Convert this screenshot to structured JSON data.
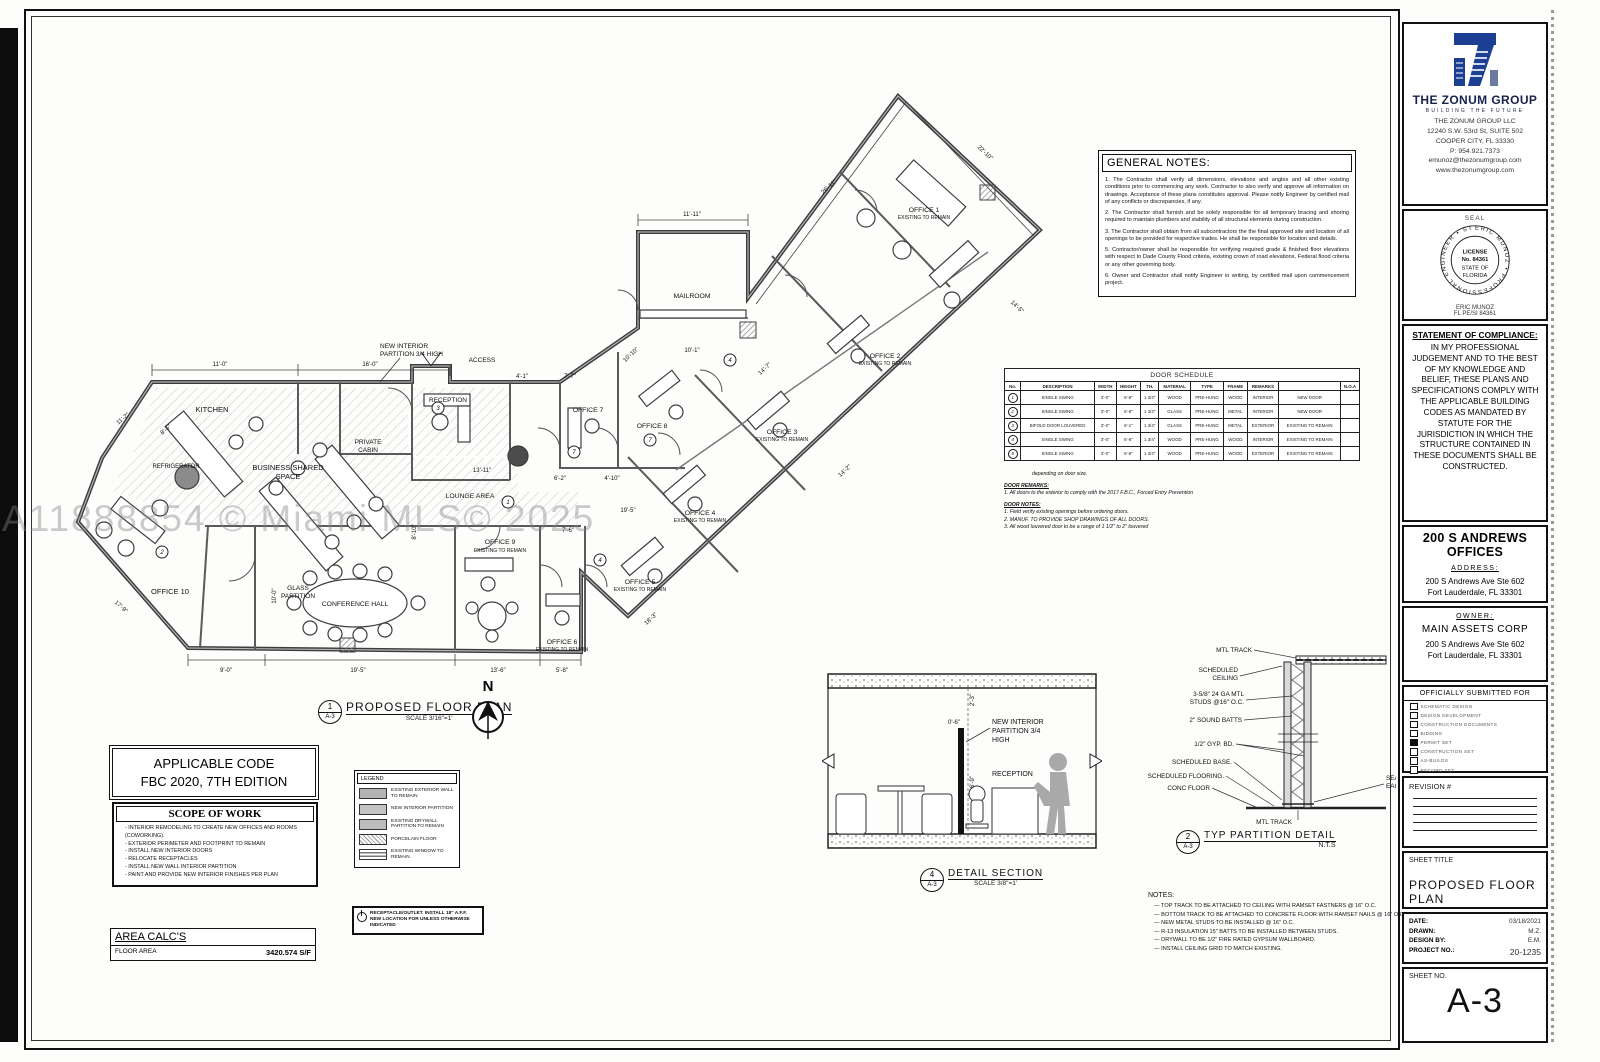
{
  "watermark": "A11888854 © Miami MLS© 2025",
  "title_block": {
    "company": {
      "name": "THE ZONUM GROUP",
      "tagline": "BUILDING THE FUTURE",
      "llc": "THE ZONUM GROUP LLC",
      "address1": "12240 S.W. 53rd St, SUITE 502",
      "address2": "COOPER CITY, FL 33330",
      "phone": "P: 954.921.7373",
      "email": "emunoz@thezonumgroup.com",
      "website": "www.thezonumgroup.com",
      "logo_color": "#1c3f94"
    },
    "seal": {
      "label": "SEAL",
      "ring_text": "ERIC MUNOZ • PROFESSIONAL ENGINEER • STATE OF FLORIDA •",
      "line1": "LICENSE",
      "line2": "No. 84361",
      "line3": "STATE OF",
      "line4": "FLORIDA",
      "engineer": "ERIC MUNOZ",
      "license": "FL PE/SI 84361"
    },
    "compliance": {
      "heading": "STATEMENT OF COMPLIANCE:",
      "body": "IN MY PROFESSIONAL JUDGEMENT AND TO THE BEST OF MY KNOWLEDGE AND BELIEF, THESE PLANS AND SPECIFICATIONS COMPLY WITH THE APPLICABLE BUILDING CODES AS MANDATED BY STATUTE FOR THE JURISDICTION IN WHICH THE STRUCTURE CONTAINED IN THESE DOCUMENTS SHALL BE CONSTRUCTED."
    },
    "project": {
      "name": "200 S ANDREWS OFFICES",
      "address_heading": "ADDRESS:",
      "address1": "200 S Andrews Ave Ste 602",
      "address2": "Fort Lauderdale, FL 33301"
    },
    "owner": {
      "heading": "OWNER:",
      "name": "MAIN ASSETS CORP",
      "address1": "200 S Andrews Ave Ste 602",
      "address2": "Fort Lauderdale, FL 33301"
    },
    "submitted_for": {
      "heading": "OFFICIALLY SUBMITTED FOR",
      "items": [
        {
          "label": "SCHEMATIC DESIGN",
          "checked": false
        },
        {
          "label": "DESIGN DEVELOPMENT",
          "checked": false
        },
        {
          "label": "CONSTRUCTION DOCUMENTS",
          "checked": false
        },
        {
          "label": "BIDDING",
          "checked": false
        },
        {
          "label": "PERMIT SET",
          "checked": true
        },
        {
          "label": "CONSTRUCTION SET",
          "checked": false
        },
        {
          "label": "AS-BUILDS",
          "checked": false
        },
        {
          "label": "RECORD SET",
          "checked": false
        }
      ]
    },
    "revision_heading": "REVISION #",
    "sheet": {
      "title_label": "SHEET TITLE",
      "title": "PROPOSED FLOOR PLAN",
      "date_label": "DATE:",
      "date": "03/18/2021",
      "drawn_label": "DRAWN:",
      "drawn": "M.Z.",
      "design_label": "DESIGN BY:",
      "design": "E.M.",
      "project_no_label": "PROJECT NO.:",
      "project_no": "20-1235",
      "sheet_no_label": "SHEET NO.",
      "sheet_no": "A-3"
    }
  },
  "general_notes": {
    "heading": "GENERAL NOTES:",
    "items": [
      "1. The Contractor shall verify all dimensions, elevations and angles and all other existing conditions prior to commencing any work. Contractor to also verify and approve all information on drawings. Acceptance of these plans constitutes approval. Please notify Engineer by certified mail of any conflicts or discrepancies, if any.",
      "2. The Contractor shall furnish and be solely responsible for all temporary bracing and shoring required to maintain plumbers and stability of all structural elements during construction.",
      "3. The Contractor shall obtain from all subcontractors the the final approved site and location of all openings to be provided for respective trades.  He shall be responsible for location and details.",
      "5. Contractor/owner shall be responsible for verifying required grade & finished floor elevations with respect to Dade County Flood criteria, existing crown of road elevations, Federal flood criteria or any other governing body.",
      "6. Owner and Contractor shall notify Engineer in writing, by certified mail upon commencement project."
    ]
  },
  "door_schedule": {
    "title": "DOOR SCHEDULE",
    "columns": [
      "No.",
      "DESCRIPTION",
      "WIDTH",
      "HEIGHT",
      "TH.",
      "MATERIAL",
      "TYPE",
      "FRAME",
      "REMARKS",
      "",
      "N.O.A"
    ],
    "rows": [
      [
        "1",
        "SINGLE SWING",
        "3'-0\"",
        "6'-8\"",
        "1 3/4\"",
        "WOOD",
        "PRE-HUNG",
        "WOOD",
        "INTERIOR",
        "NEW DOOR",
        ""
      ],
      [
        "2",
        "SINGLE SWING",
        "3'-0\"",
        "6'-8\"",
        "1 3/4\"",
        "GLASS",
        "PRE-HUNG",
        "METAL",
        "INTERIOR",
        "NEW DOOR",
        ""
      ],
      [
        "3",
        "BIFOLD DOOR LOUVERED",
        "3'-0\"",
        "6'-1\"",
        "1 3/4\"",
        "GLASS",
        "PRE-HUNG",
        "METAL",
        "EXTERIOR",
        "EXISTING TO REMAIN",
        ""
      ],
      [
        "4",
        "SINGLE SWING",
        "3'-0\"",
        "6'-8\"",
        "1 3/4\"",
        "WOOD",
        "PRE-HUNG",
        "WOOD",
        "INTERIOR",
        "EXISTING TO REMAIN",
        ""
      ],
      [
        "5",
        "SINGLE SWING",
        "3'-0\"",
        "6'-8\"",
        "1 3/4\"",
        "WOOD",
        "PRE-HUNG",
        "WOOD",
        "EXTERIOR",
        "EXISTING TO REMAIN",
        ""
      ]
    ],
    "lead_note": "depending on door size.",
    "remarks_heading": "DOOR REMARKS:",
    "remarks": [
      "1. All doors to the exterior to comply with the 2017 F.B.C., Forced Entry Prevention"
    ],
    "notes_heading": "DOOR NOTES:",
    "notes": [
      "1. Field verify existing openings before ordering doors.",
      "2. MANUF. TO PROVIDE SHOP DRAWINGS OF ALL DOORS.",
      "3. All wood louvered door to be a range of 1 1/2\" to 2\" louvered"
    ]
  },
  "applicable_code": {
    "line1": "APPLICABLE CODE",
    "line2": "FBC 2020, 7TH EDITION"
  },
  "scope_of_work": {
    "heading": "SCOPE OF WORK",
    "items": [
      "INTERIOR REMODELING  TO CREATE NEW OFFICES AND ROOMS (COWORKING).",
      "EXTERIOR PERIMETER AND FOOTPRINT TO REMAIN",
      "INSTALL NEW INTERIOR DOORS",
      "RELOCATE RECEPTACLES",
      "INSTALL NEW WALL INTERIOR PARTITION",
      "PAINT AND PROVIDE NEW INTERIOR FINISHES PER PLAN"
    ]
  },
  "area_calcs": {
    "heading": "AREA CALC'S",
    "row_label": "FLOOR AREA",
    "value": "3420.574 S/F"
  },
  "legend": {
    "heading": "LEGEND",
    "items": [
      {
        "label": "EXISTING EXTERIOR WALL TO REMAIN",
        "class": "sw-solid"
      },
      {
        "label": "NEW INTERIOR PARTITION",
        "class": "sw-solid2"
      },
      {
        "label": "EXISTING DRYWALL PARTITION TO REMAIN",
        "class": "sw-solid3"
      },
      {
        "label": "PORCELAIN FLOOR",
        "class": "sw-hatch"
      },
      {
        "label": "EXISTING WINDOW TO REMAIN",
        "class": "sw-window"
      }
    ]
  },
  "receptacle_note": "RECEPTACLE/OUTLET. INSTALL 18\" A.F.F. NEW LOCATION FOR UNLESS OTHERWISE INDICATED",
  "plan": {
    "figure": {
      "num": "1",
      "sheet": "A-3",
      "title": "PROPOSED FLOOR PLAN",
      "scale": "SCALE 3/16\"=1'"
    },
    "north": "N",
    "labels": {
      "kitchen": "KITCHEN",
      "refrigerator": "REFRIGERATOR",
      "shared1": "BUSINESS  SHARED",
      "shared2": "SPACE",
      "private1": "PRIVATE",
      "private2": "CABIN",
      "reception": "RECEPTION",
      "office10": "OFFICE  10",
      "glass1": "GLASS",
      "glass2": "PARTITION",
      "conference": "CONFERENCE  HALL",
      "lounge": "LOUNGE  AREA",
      "access": "ACCESS",
      "newpart1": "NEW  INTERIOR",
      "newpart2": "PARTITION  3/4   HIGH",
      "office7": "OFFICE  7",
      "office8": "OFFICE  8",
      "office9": "OFFICE  9",
      "office6": "OFFICE  6",
      "office5": "OFFICE  5",
      "office4": "OFFICE  4",
      "office3": "OFFICE  3",
      "office2": "OFFICE  2",
      "office1": "OFFICE  1",
      "existing": "EXISTING TO REMAIN",
      "mailroom": "MAILROOM"
    },
    "tags": {
      "t1": "1",
      "t2": "2",
      "t3": "3",
      "t4": "4",
      "t5": "7",
      "t6": "4"
    },
    "dims": {
      "d1": "11'-0\"",
      "d2": "16'-0\"",
      "d3": "8'-5\"",
      "d4": "11'-2\"",
      "d5": "26'-11\"",
      "d6": "22'-10\"",
      "d7": "11'-11\"",
      "d8": "10'-1\"",
      "d9": "14'-5\"",
      "d10": "14'-7\"",
      "d11": "14'-2\"",
      "d12": "13'-11\"",
      "d13": "19'-5\"",
      "d14": "9'-0\"",
      "d15": "19'-5\"",
      "d16": "13'-6\"",
      "d17": "5'-8\"",
      "d18": "7'-7\"",
      "d19": "7'-6\"",
      "d20": "18'-3\"",
      "d21": "8'-10\"",
      "d22": "17'-9\"",
      "d23": "10'-10\"",
      "d24": "4'-1\"",
      "d25": "6'-2\"",
      "d26": "4'-10\"",
      "d27": "10'-0\""
    }
  },
  "detail_section": {
    "figure": {
      "num": "4",
      "sheet": "A-3",
      "title": "DETAIL SECTION",
      "scale": "SCALE 3/8\"=1'"
    },
    "labels": {
      "part1": "NEW  INTERIOR",
      "part2": "PARTITION  3/4",
      "part3": "HIGH",
      "reception": "RECEPTION",
      "dim1": "2'-3\"",
      "dim2": "6'-9\"",
      "dim3": "0'-6\""
    }
  },
  "partition_detail": {
    "figure": {
      "num": "2",
      "sheet": "A-3",
      "title": "TYP  PARTITION  DETAIL",
      "scale": "N.T.S"
    },
    "labels": {
      "mtl_top": "MTL  TRACK",
      "ceil1": "SCHEDULED",
      "ceil2": "CEILING",
      "studs1": "3-5/8\" 24 GA MTL",
      "studs2": "STUDS @16\" O.C.",
      "batts": "2\" SOUND BATTS",
      "gyp": "1/2\" GYP. BD.",
      "base": "SCHEDULED BASE.",
      "floor": "SCHEDULED FLOORING.",
      "conc": "CONC FLOOR",
      "seal1": "SEALANT",
      "seal2": "EACH SIDE",
      "mtl_bot": "MTL  TRACK"
    }
  },
  "partition_notes": {
    "heading": "NOTES:",
    "items": [
      "TOP TRACK TO BE ATTACHED TO CEILING WITH RAMSET FASTNERS @ 16\" O.C.",
      "BOTTOM TRACK TO BE ATTACHED TO CONCRETE FLOOR WITH RAMSET NAILS @ 16\" O.C.",
      "NEW METAL STUDS TO BE INSTALLED @ 16\" O.C.",
      "R-13 INSULATION 15\" BATTS TO BE INSTALLED BETWEEN STUDS.",
      "DRYWALL TO BE 1/2\" FIRE RATED GYPSUM WALLBOARD.",
      "INSTALL CEILING GRID TO MATCH EXISTING."
    ]
  }
}
